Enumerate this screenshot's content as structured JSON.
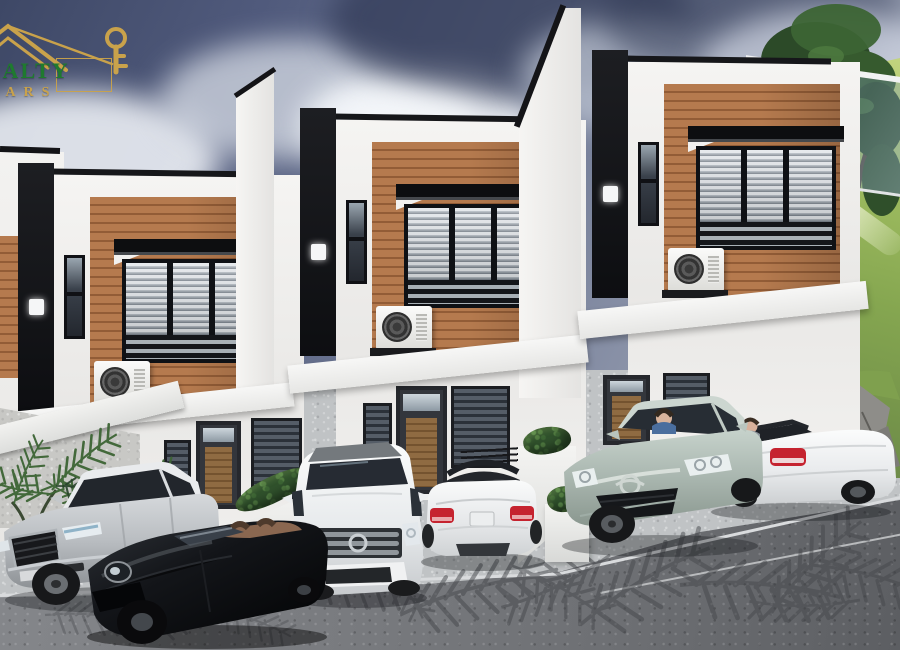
{
  "page": {
    "title": "Townhouse development 3D exterior rendering",
    "canvas": {
      "width": 900,
      "height": 650
    }
  },
  "logo": {
    "icon": "roof-and-key-icon",
    "line1": "REALTY",
    "line2": "YEARS",
    "colors": {
      "line1_green": "#1f7a2f",
      "gold": "#c9a24b"
    }
  },
  "scene": {
    "description": "Row of three modern two-storey townhouses stepping up a slope, cars parked in the driveways, cloudy sky, grassy hill with tree at right, palm-frond shadows on the road",
    "sky": {
      "base": "#3e4866",
      "cloud_light": "#eff2f7",
      "cloud_dark": "#2a324e"
    },
    "houses": {
      "count": 3,
      "palette": {
        "wall": "#f2f1ef",
        "accent_panel": "#141519",
        "wood_slats": "#b57a4e",
        "window_frame": "#0f1115",
        "blinds": "#aab2ba"
      },
      "features_per_unit": [
        "black accent panel with wall lamp",
        "wood-slat feature wall",
        "louvered picture window with black canopy",
        "air-conditioner on ledge",
        "entry door with transom and wood insert",
        "ground-floor windows with blinds",
        "white planter boxes with hedges"
      ]
    },
    "vehicles": [
      {
        "id": "car-1",
        "type": "sedan",
        "color": "silver",
        "hex": "#c3c7ca",
        "view": "front-three-quarter",
        "location": "left driveway"
      },
      {
        "id": "car-2",
        "type": "sports convertible",
        "color": "black",
        "hex": "#141518",
        "view": "front-three-quarter",
        "location": "left driveway"
      },
      {
        "id": "car-3",
        "type": "suv",
        "color": "white",
        "hex": "#f2f3f4",
        "view": "front",
        "location": "middle driveway"
      },
      {
        "id": "car-4",
        "type": "convertible",
        "color": "white",
        "hex": "#f2f3f4",
        "view": "rear",
        "location": "middle driveway"
      },
      {
        "id": "car-5",
        "type": "sedan with driver",
        "color": "pale sage",
        "hex": "#b7c3bc",
        "view": "front-three-quarter",
        "location": "right driveway"
      },
      {
        "id": "car-6",
        "type": "convertible with driver",
        "color": "white",
        "hex": "#f2f3f4",
        "view": "rear-three-quarter",
        "location": "right driveway"
      }
    ],
    "landscape": {
      "hill": {
        "color": "#8fae54",
        "position": "right"
      },
      "tree": {
        "foliage": "#33522c",
        "position": "upper-right"
      },
      "rocks": {
        "color": "#9b9a96",
        "position": "lower-right"
      },
      "palm_shadows": {
        "color": "#45474b",
        "position": "road foreground"
      },
      "plants": {
        "color": "#37582f",
        "position": "lower-left"
      },
      "glass_canopy": {
        "color": "rgba(140,170,195,0.4)",
        "position": "right of third unit"
      }
    },
    "ground": {
      "driveway": "#c0c3c5",
      "road": "#75777b"
    }
  }
}
